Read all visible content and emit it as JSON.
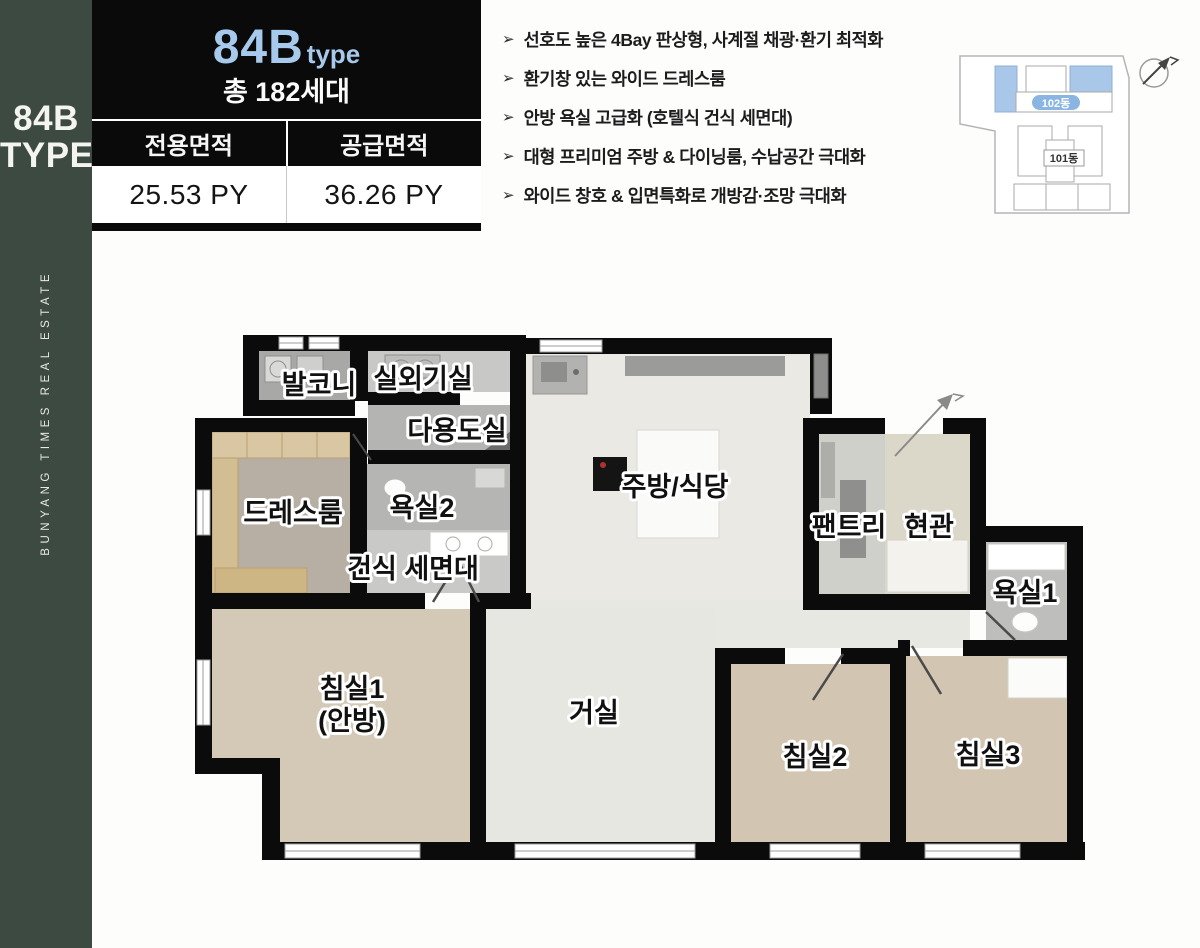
{
  "sidebar": {
    "title_line1": "84B",
    "title_line2": "TYPE",
    "vertical_text": "BUNYANG TIMES REAL ESTATE",
    "bg_color": "#3d4a42"
  },
  "info_card": {
    "type_main": "84B",
    "type_suffix": "type",
    "households": "총 182세대",
    "col1_header": "전용면적",
    "col2_header": "공급면적",
    "col1_value": "25.53 PY",
    "col2_value": "36.26 PY",
    "accent_color": "#a6c9ec"
  },
  "features": {
    "bullet": "➢",
    "items": [
      "선호도 높은 4Bay 판상형, 사계절 채광·환기 최적화",
      "환기창 있는 와이드 드레스룸",
      "안방 욕실 고급화 (호텔식 건식 세면대)",
      "대형 프리미엄 주방 & 다이닝룸, 수납공간 극대화",
      "와이드 창호 & 입면특화로 개방감·조망 극대화"
    ]
  },
  "site_plan": {
    "building_top_label": "102동",
    "building_bottom_label": "101동",
    "highlight_color": "#a9c7e8"
  },
  "floor_plan": {
    "rooms": {
      "balcony": "발코니",
      "outdoor_unit": "실외기실",
      "utility": "다용도실",
      "dress_room": "드레스룸",
      "bath2": "욕실2",
      "dry_vanity": "건식 세면대",
      "kitchen_dining": "주방/식당",
      "pantry": "팬트리",
      "entrance": "현관",
      "bath1": "욕실1",
      "bedroom1": "침실1",
      "bedroom1_sub": "(안방)",
      "living": "거실",
      "bedroom2": "침실2",
      "bedroom3": "침실3"
    }
  }
}
